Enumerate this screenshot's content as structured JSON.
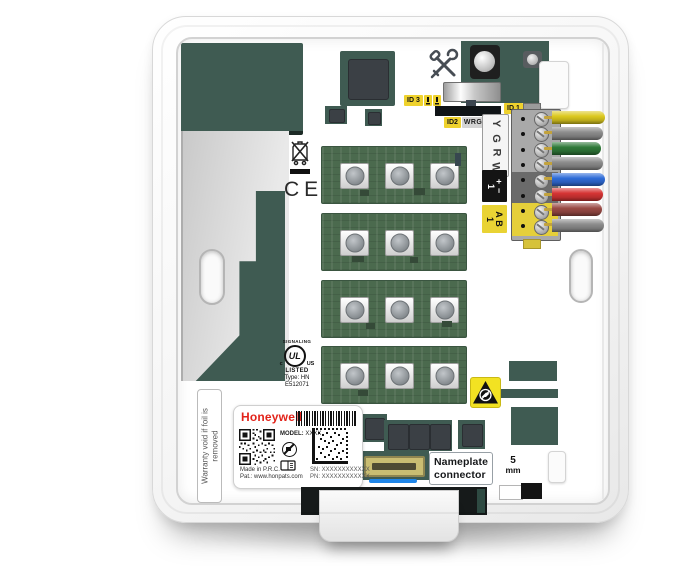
{
  "id_labels": {
    "id3": "ID 3",
    "id1": "ID 1",
    "id2": "ID2",
    "id2_wires": "WRGY"
  },
  "terminals": {
    "letters": [
      "Y",
      "G",
      "R",
      "W"
    ],
    "power": {
      "group": "1",
      "plus": "+",
      "minus": "−"
    },
    "bus": {
      "group": "1",
      "a": "A",
      "b": "B"
    },
    "wire_colors": [
      "#dcc91f",
      "#8d8d8d",
      "#2f7a39",
      "#8d8d8d",
      "#2f6cd8",
      "#d63434",
      "#9a4a45",
      "#8d8d8d"
    ]
  },
  "certifications": {
    "ce": "CE",
    "ul": {
      "signaling": "SIGNALING",
      "prefix": "c",
      "mark": "UL",
      "suffix": "US",
      "listed": "LISTED",
      "type": "Type: HN",
      "file": "E512071"
    }
  },
  "warranty": {
    "line1": "Warranty void if foil is",
    "line2": "removed"
  },
  "product_label": {
    "brand": "Honeywell",
    "model_label": "MODEL:",
    "model_value": "XXXX",
    "made_in": "Made in P.R.C.",
    "patent": "Pat.: www.honpats.com",
    "serial": "SN: XXXXXXXXXXXX",
    "part": "PN: XXXXXXXXXXXX"
  },
  "callouts": {
    "nameplate_line1": "Nameplate",
    "nameplate_line2": "connector",
    "scale_value": "5",
    "scale_unit": "mm"
  },
  "icons": {
    "tools": "crossed-screwdriver-and-wrench",
    "weee": "crossed-out-wheelie-bin",
    "esd": "esd-susceptibility-triangle",
    "no_dispose": "circle-slash",
    "manual": "booklet",
    "qr": "qr-code",
    "data_matrix": "data-matrix-code",
    "barcode": "barcode"
  },
  "colors": {
    "pcb": "#3f5b52",
    "label_yellow": "#efd22d",
    "brand_red": "#e2231a",
    "blue_line": "#1f86e8"
  }
}
